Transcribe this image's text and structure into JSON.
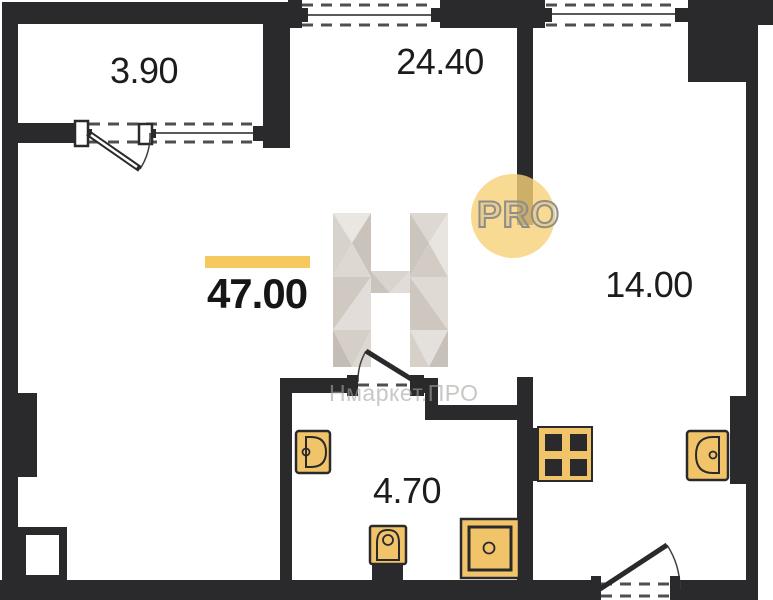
{
  "floor_plan": {
    "total_area": "47.00",
    "rooms": [
      {
        "id": "balcony",
        "area": "3.90"
      },
      {
        "id": "living-room",
        "area": "24.40"
      },
      {
        "id": "kitchen-living-room",
        "area": "14.00"
      },
      {
        "id": "bathroom",
        "area": "4.70"
      }
    ],
    "fixtures": [
      "bath-sink",
      "toilet",
      "shower-tray",
      "stove",
      "kitchen-sink"
    ],
    "watermark": {
      "logo_letter": "H",
      "badge_text": "PRO",
      "site_name": "Нмаркет.ПРО"
    },
    "colors": {
      "walls": "#2a2a2d",
      "fixtures": "#f2c469",
      "accent_bar": "#f6c85d",
      "badge_background": "#f6d177",
      "watermark_gray": "#d9d4cf"
    }
  }
}
